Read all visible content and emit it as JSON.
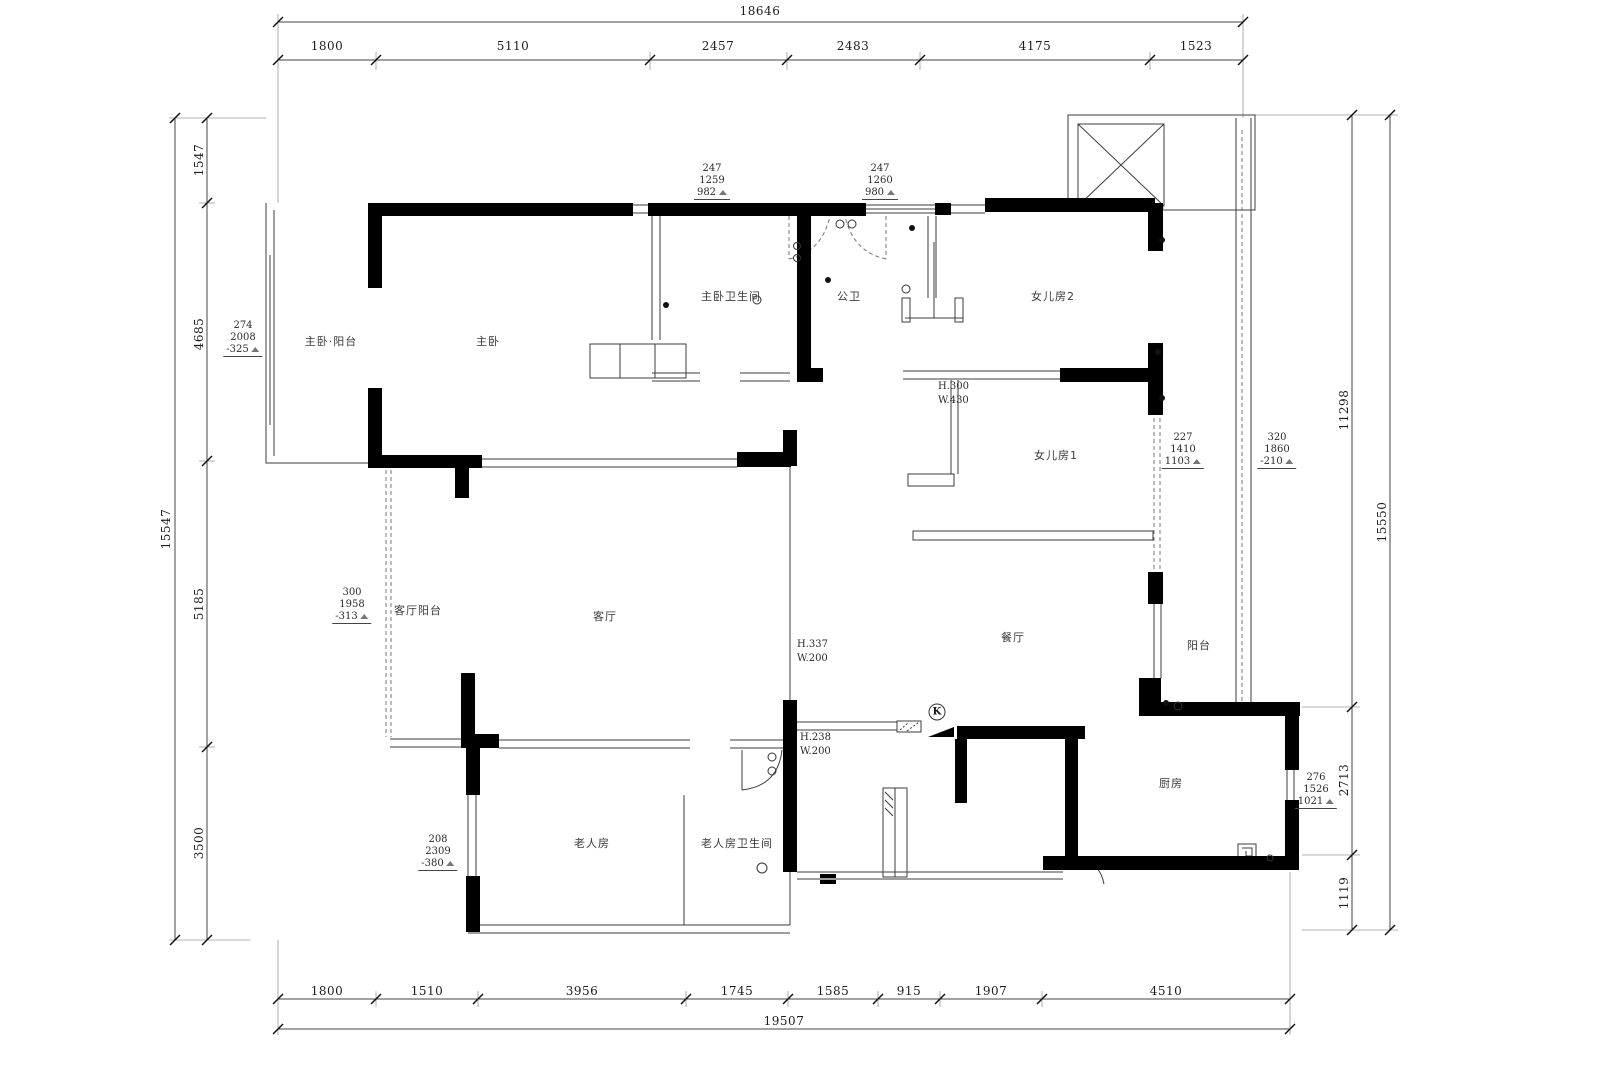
{
  "dimensions": {
    "top": {
      "total": "18646",
      "segments": [
        "1800",
        "5110",
        "2457",
        "2483",
        "4175",
        "1523"
      ]
    },
    "bottom": {
      "total": "19507",
      "segments": [
        "1800",
        "1510",
        "3956",
        "1745",
        "1585",
        "915",
        "1907",
        "4510"
      ]
    },
    "left": {
      "total": "15547",
      "segments": [
        "1547",
        "4685",
        "5185",
        "3500"
      ]
    },
    "right": {
      "total": "15550",
      "segments": [
        "11298",
        "2713",
        "1119"
      ]
    }
  },
  "rooms": {
    "master_balcony": "主卧·阳台",
    "master_bedroom": "主卧",
    "master_bathroom": "主卧卫生间",
    "public_bathroom": "公卫",
    "daughter_room_2": "女儿房2",
    "daughter_room_1": "女儿房1",
    "living_balcony": "客厅阳台",
    "living_room": "客厅",
    "dining_room": "餐厅",
    "balcony": "阳台",
    "kitchen": "厨房",
    "elderly_room": "老人房",
    "elderly_bathroom": "老人房卫生间"
  },
  "window_marks": {
    "top_left": [
      "247",
      "1259",
      "982"
    ],
    "top_right": [
      "247",
      "1260",
      "980"
    ],
    "master_balcony": [
      "274",
      "2008",
      "-325"
    ],
    "daughter_room_1": [
      "227",
      "1410",
      "1103"
    ],
    "east_balcony": [
      "320",
      "1860",
      "-210"
    ],
    "living_balcony": [
      "300",
      "1958",
      "-313"
    ],
    "elderly_room": [
      "208",
      "2309",
      "-380"
    ],
    "kitchen": [
      "276",
      "1526",
      "1021"
    ]
  },
  "openings": {
    "daughter_sill": [
      "H.300",
      "W.430"
    ],
    "living_sill": [
      "H.337",
      "W.200"
    ],
    "entry_sill": [
      "H.238",
      "W.200"
    ]
  },
  "symbols": {
    "kitchen_k": "K"
  }
}
